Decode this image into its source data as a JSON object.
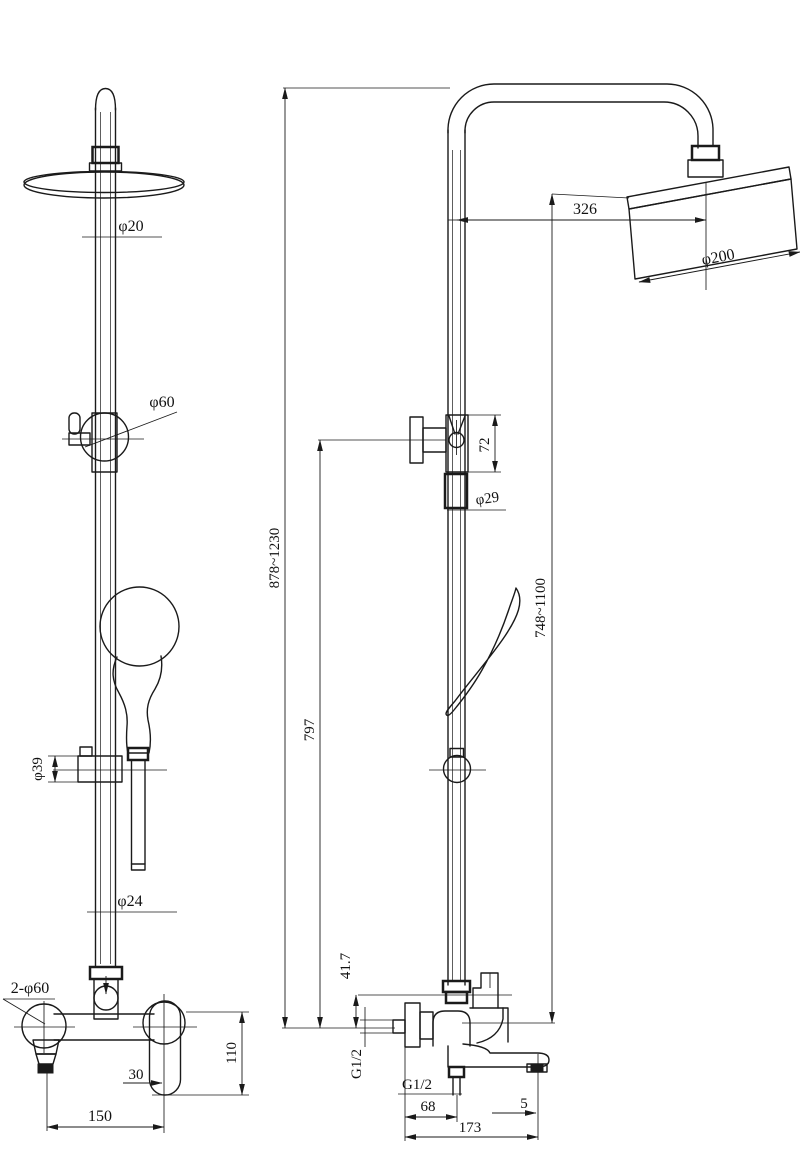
{
  "drawing": {
    "subject": "shower-column-technical-drawing",
    "background_color": "#ffffff",
    "line_color": "#1a1a1a",
    "views": {
      "front_label": "front view",
      "side_label": "side view"
    },
    "dims": {
      "front": {
        "rod_top_diameter": "φ20",
        "slider_bracket_diameter": "φ60",
        "holder_diameter": "φ39",
        "rod_bottom_diameter": "φ24",
        "wall_flanges": "2-φ60",
        "handle_offset": "30",
        "handle_height": "110",
        "inlet_center_distance": "150"
      },
      "side": {
        "head_center_offset": "326",
        "head_diameter": "φ200",
        "overall_height_range": "878~1230",
        "riser_height": "797",
        "head_height_range": "748~1100",
        "bracket_height": "72",
        "pipe_diameter": "φ29",
        "body_drop": "41.7",
        "wall_inlet_thread": "G1/2",
        "hose_outlet_thread": "G1/2",
        "outlet_offset": "68",
        "spout_tip_offset": "5",
        "spout_reach": "173"
      }
    }
  }
}
